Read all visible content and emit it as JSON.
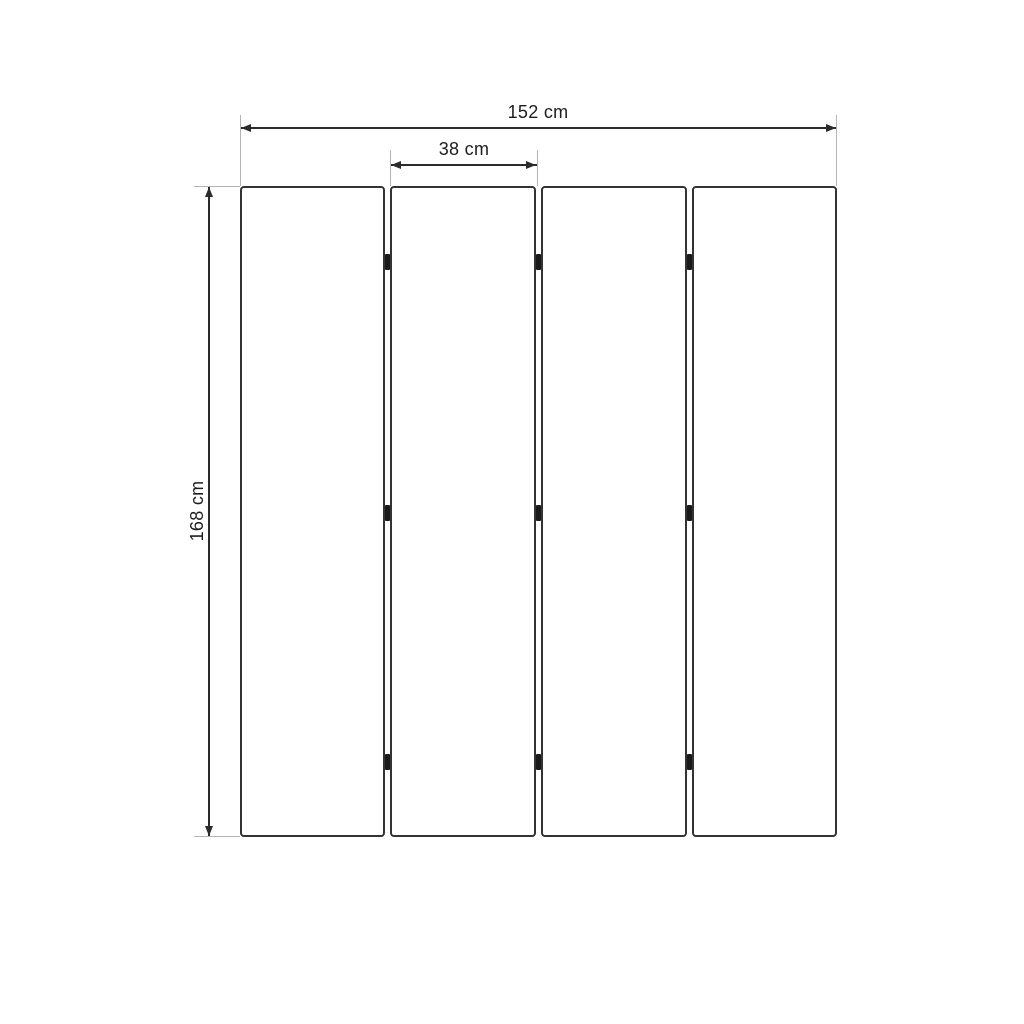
{
  "diagram": {
    "type": "dimensioned-technical-drawing",
    "panel_count": 4,
    "hinges_per_gap": 3,
    "dimensions": {
      "total_width": {
        "value": 152,
        "unit": "cm",
        "label": "152 cm"
      },
      "panel_width": {
        "value": 38,
        "unit": "cm",
        "label": "38 cm"
      },
      "height": {
        "value": 168,
        "unit": "cm",
        "label": "168 cm"
      }
    },
    "colors": {
      "background": "#ffffff",
      "panel_fill": "#ffffff",
      "panel_border": "#333333",
      "dimension_line": "#2b2b2b",
      "extension_line": "#b4b4b4",
      "hinge": "#1a1a1a",
      "text": "#1d1d1d"
    }
  }
}
